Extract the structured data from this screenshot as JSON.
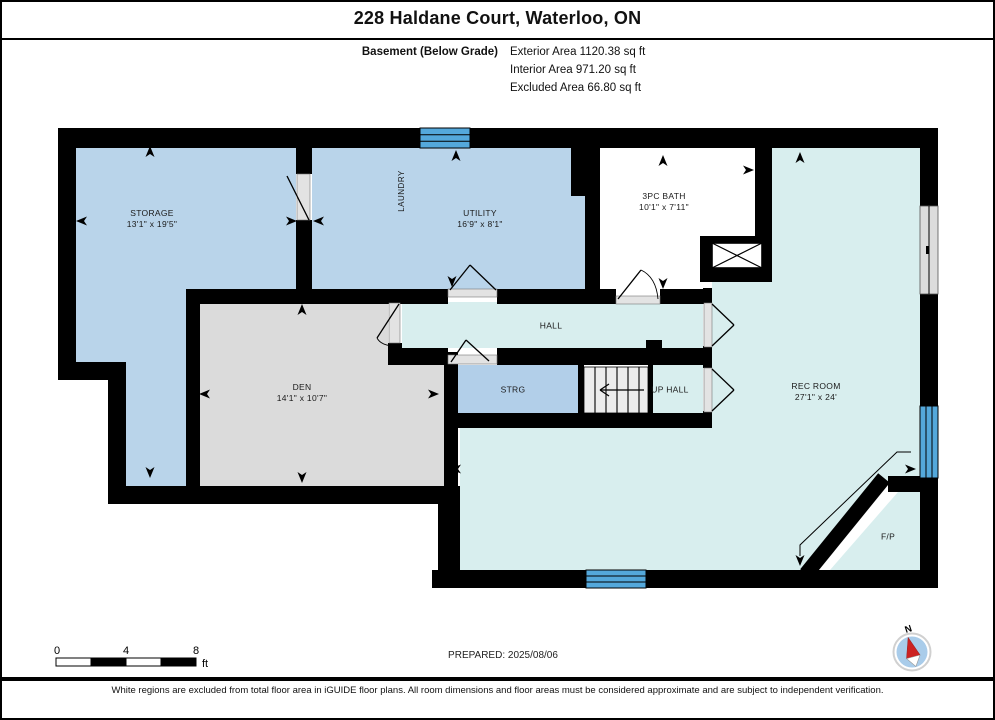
{
  "header": {
    "title": "228 Haldane Court, Waterloo, ON",
    "level_label": "Basement (Below Grade)",
    "areas": [
      "Exterior Area 1120.38 sq ft",
      "Interior Area 971.20 sq ft",
      "Excluded Area 66.80 sq ft"
    ]
  },
  "rooms": {
    "storage": {
      "name": "STORAGE",
      "dims": "13'1\" x 19'5\""
    },
    "laundry": {
      "name": "LAUNDRY"
    },
    "utility": {
      "name": "UTILITY",
      "dims": "16'9\" x 8'1\""
    },
    "bath": {
      "name": "3PC BATH",
      "dims": "10'1\" x 7'11\""
    },
    "den": {
      "name": "DEN",
      "dims": "14'1\" x 10'7\""
    },
    "hall": {
      "name": "HALL"
    },
    "strg": {
      "name": "STRG"
    },
    "up_hall": {
      "name": "UP HALL"
    },
    "rec_room": {
      "name": "REC ROOM",
      "dims": "27'1\" x 24'"
    },
    "fireplace": {
      "name": "F/P"
    }
  },
  "scale_bar": {
    "labels": [
      "0",
      "4",
      "8"
    ],
    "unit": "ft"
  },
  "prepared_label": "PREPARED: 2025/08/06",
  "compass": {
    "north_label": "N"
  },
  "footer_note": "White regions are excluded from total floor area in iGUIDE floor plans. All room dimensions and floor areas must be considered approximate and are subject to independent verification.",
  "colors": {
    "room_blue": "#B9D4EA",
    "room_gray": "#DBDBDB",
    "room_cyan": "#D8EEEE",
    "window_blue": "#54A8DB",
    "wall_black": "#000000",
    "compass_red": "#CC2222",
    "compass_blue": "#A9CCEA"
  }
}
